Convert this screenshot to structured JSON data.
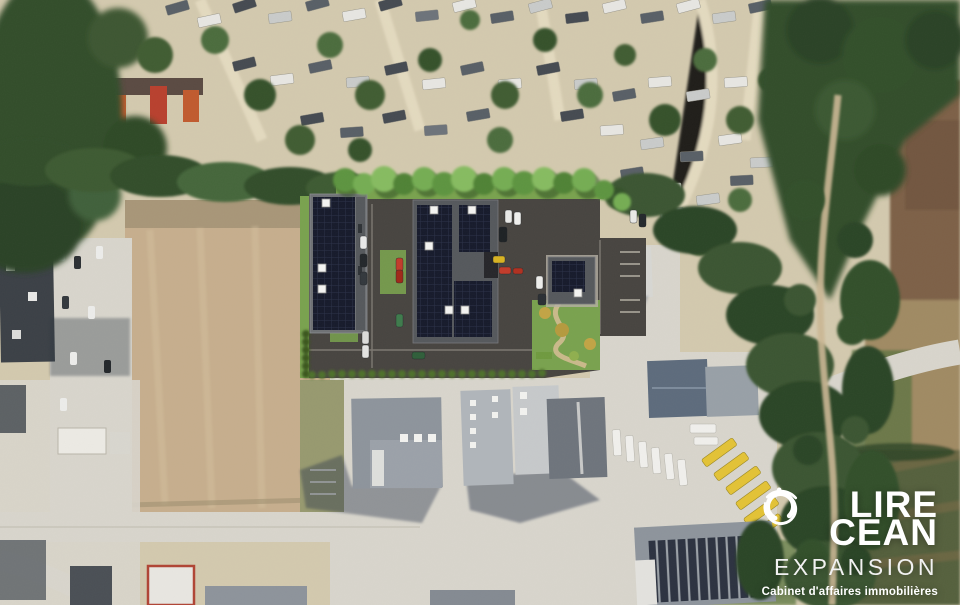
{
  "logo": {
    "word1_prefix": "L",
    "word1_suffix": "IRE",
    "word2_suffix": "CEAN",
    "word3": "EXPANSION",
    "tagline": "Cabinet d'affaires immobilières"
  },
  "palette": {
    "logo_text": "#ffffff",
    "logo_sub": "#f1f1f1",
    "solar_panel": "#161a2b",
    "solar_grid": "#2b3148",
    "render_asphalt": "#474440",
    "render_grass": "#79a24e",
    "render_tree": "#6aa348",
    "building_frame": "#6e7174",
    "roof_deck": "#55585c",
    "field_tan": "#c6ae8d",
    "forest_green": "#334d2a",
    "campsite_sand": "#d3c9ae",
    "road_concrete": "#d8d5cc",
    "industrial_roof": "#8d949c",
    "truck_yellow": "#e3c236",
    "container_orange": "#c05a2e"
  }
}
